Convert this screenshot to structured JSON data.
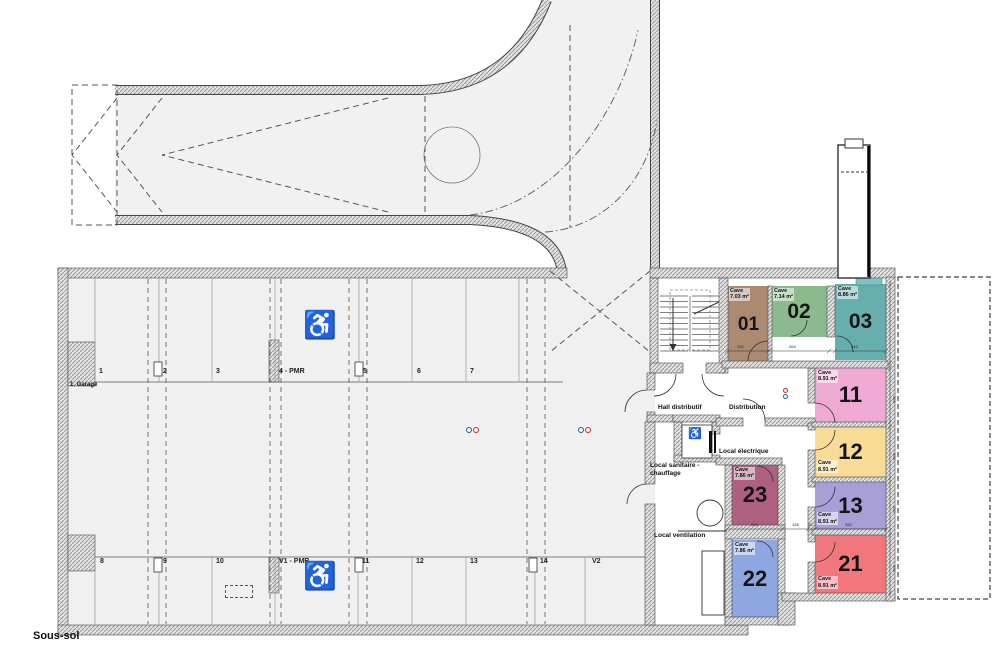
{
  "plan": {
    "floor_label": "Sous-sol",
    "zone_label": "1. Garage",
    "cave_word": "Cave",
    "stalls": {
      "top_y": 368,
      "bottom_y": 558,
      "top": [
        {
          "label": "1",
          "x": 99
        },
        {
          "label": "2",
          "x": 163
        },
        {
          "label": "3",
          "x": 216
        },
        {
          "label": "4 - PMR",
          "x": 279
        },
        {
          "label": "5",
          "x": 363
        },
        {
          "label": "6",
          "x": 417
        },
        {
          "label": "7",
          "x": 470
        }
      ],
      "bottom": [
        {
          "label": "8",
          "x": 100
        },
        {
          "label": "9",
          "x": 163
        },
        {
          "label": "10",
          "x": 216
        },
        {
          "label": "V1 - PMR",
          "x": 279
        },
        {
          "label": "11",
          "x": 362
        },
        {
          "label": "12",
          "x": 416
        },
        {
          "label": "13",
          "x": 470
        },
        {
          "label": "14",
          "x": 540
        },
        {
          "label": "V2",
          "x": 592
        }
      ]
    },
    "caves": [
      {
        "num": "01",
        "area": "7.03 m²",
        "x": 727,
        "y": 286,
        "w": 43,
        "h": 77,
        "color": "#ab8a71",
        "label_pos": "tl",
        "num_size": 19
      },
      {
        "num": "02",
        "area": "7.14 m²",
        "x": 771,
        "y": 286,
        "w": 56,
        "h": 51,
        "color": "#8cba8e",
        "label_pos": "tl",
        "num_size": 21
      },
      {
        "num": "03",
        "area": "8.86 m²",
        "x": 835,
        "y": 284,
        "w": 51,
        "h": 76,
        "color": "#67afac",
        "label_pos": "tl",
        "num_size": 21
      },
      {
        "num": "11",
        "area": "8.91 m²",
        "x": 815,
        "y": 368,
        "w": 71,
        "h": 54,
        "color": "#eeaad2",
        "label_pos": "tl",
        "num_size": 22
      },
      {
        "num": "12",
        "area": "8.91 m²",
        "x": 815,
        "y": 427,
        "w": 71,
        "h": 50,
        "color": "#f8dc96",
        "label_pos": "bl",
        "num_size": 22
      },
      {
        "num": "13",
        "area": "8.91 m²",
        "x": 815,
        "y": 482,
        "w": 71,
        "h": 47,
        "color": "#a79fd6",
        "label_pos": "bl",
        "num_size": 22
      },
      {
        "num": "21",
        "area": "8.91 m²",
        "x": 815,
        "y": 535,
        "w": 71,
        "h": 58,
        "color": "#f2777d",
        "label_pos": "bl",
        "num_size": 22
      },
      {
        "num": "22",
        "area": "7.86 m²",
        "x": 732,
        "y": 540,
        "w": 46,
        "h": 77,
        "color": "#8fa7e0",
        "label_pos": "tl",
        "num_size": 22
      },
      {
        "num": "23",
        "area": "7.86 m²",
        "x": 732,
        "y": 465,
        "w": 46,
        "h": 60,
        "color": "#ae6080",
        "label_pos": "tl",
        "num_size": 22
      }
    ],
    "rooms": [
      {
        "key": "hall-distributif",
        "label": "Hall distributif",
        "x": 658,
        "y": 404
      },
      {
        "key": "distribution",
        "label": "Distribution",
        "x": 729,
        "y": 404
      },
      {
        "key": "local-electrique",
        "label": "Local électrique",
        "x": 719,
        "y": 448
      },
      {
        "key": "local-sanitaire-chauffage",
        "label": "Local sanitaire -\nchauffage",
        "x": 650,
        "y": 462
      },
      {
        "key": "local-ventilation",
        "label": "Local ventilation",
        "x": 654,
        "y": 532
      }
    ],
    "dimensions": {
      "row1": [
        {
          "t": "192",
          "x": 737,
          "y": 348
        },
        {
          "t": "204",
          "x": 789,
          "y": 348
        },
        {
          "t": "242",
          "x": 851,
          "y": 348
        }
      ],
      "row2": [
        {
          "t": "219",
          "x": 751,
          "y": 526
        },
        {
          "t": "128",
          "x": 792,
          "y": 526
        },
        {
          "t": "20",
          "x": 808,
          "y": 526
        },
        {
          "t": "352",
          "x": 845,
          "y": 526
        }
      ],
      "side": [
        {
          "t": "253",
          "y": 396
        },
        {
          "t": "253",
          "y": 453
        },
        {
          "t": "253",
          "y": 506
        },
        {
          "t": "253",
          "y": 565
        }
      ]
    },
    "icons": {
      "wheelchair_glyph": "♿",
      "pmr_color": "#8da0b8",
      "elevator_color": "#333333",
      "pmr_positions": [
        {
          "x": 303,
          "y": 312,
          "size": 27
        },
        {
          "x": 303,
          "y": 563,
          "size": 27
        }
      ],
      "elevator_position": {
        "x": 688,
        "y": 429,
        "size": 11
      }
    },
    "markers": {
      "blue": "#2060a8",
      "red": "#cc2a2a",
      "garage_pairs": [
        {
          "x": 466,
          "y": 427
        },
        {
          "x": 578,
          "y": 427
        }
      ],
      "distribution_stack": {
        "x": 783,
        "y": 388
      }
    }
  }
}
